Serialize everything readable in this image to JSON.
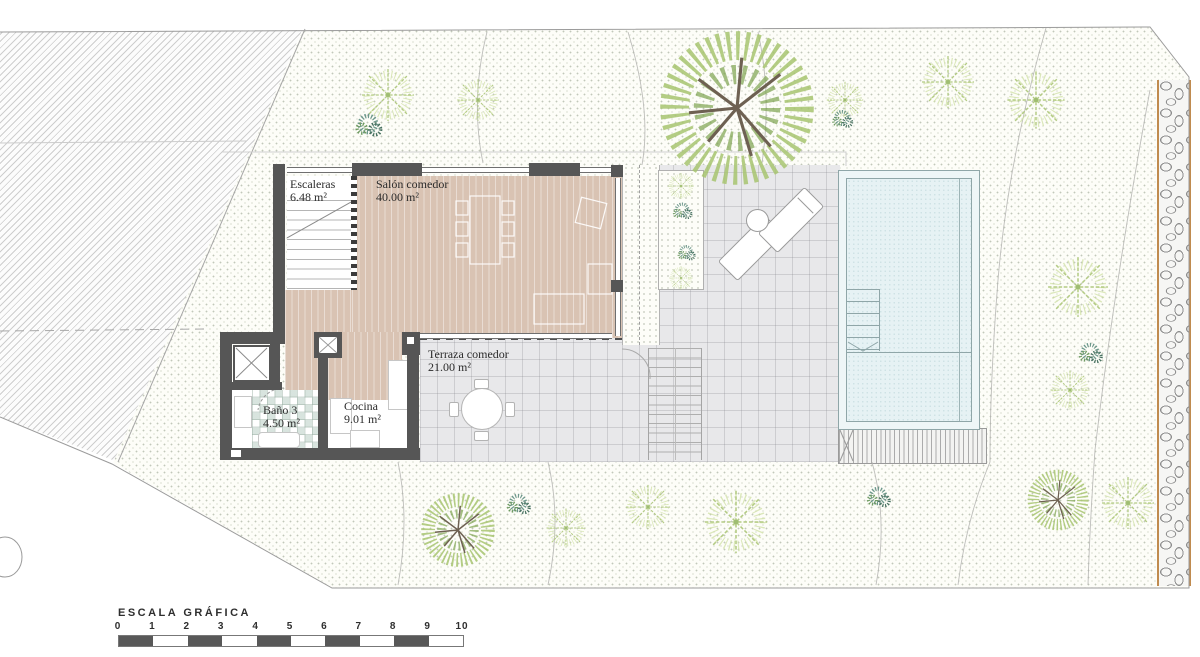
{
  "plan": {
    "rooms": [
      {
        "name": "Escaleras",
        "area": "6.48 m²"
      },
      {
        "name": "Salón comedor",
        "area": "40.00 m²"
      },
      {
        "name": "Terraza comedor",
        "area": "21.00 m²"
      },
      {
        "name": "Baño 3",
        "area": "4.50 m²"
      },
      {
        "name": "Cocina",
        "area": "9.01 m²"
      }
    ],
    "scale_bar": {
      "title": "ESCALA GRÁFICA",
      "ticks": [
        "0",
        "1",
        "2",
        "3",
        "4",
        "5",
        "6",
        "7",
        "8",
        "9",
        "10"
      ]
    },
    "colors": {
      "wall": "#565656",
      "wood_floor": "#d9c3b3",
      "deck_tile": "#e8e8ea",
      "pool_water": "#e6f2f4",
      "stone_border": "#c08b4f",
      "vegetation_green": "#a8c46a",
      "vegetation_teal": "#5d8d80"
    }
  }
}
